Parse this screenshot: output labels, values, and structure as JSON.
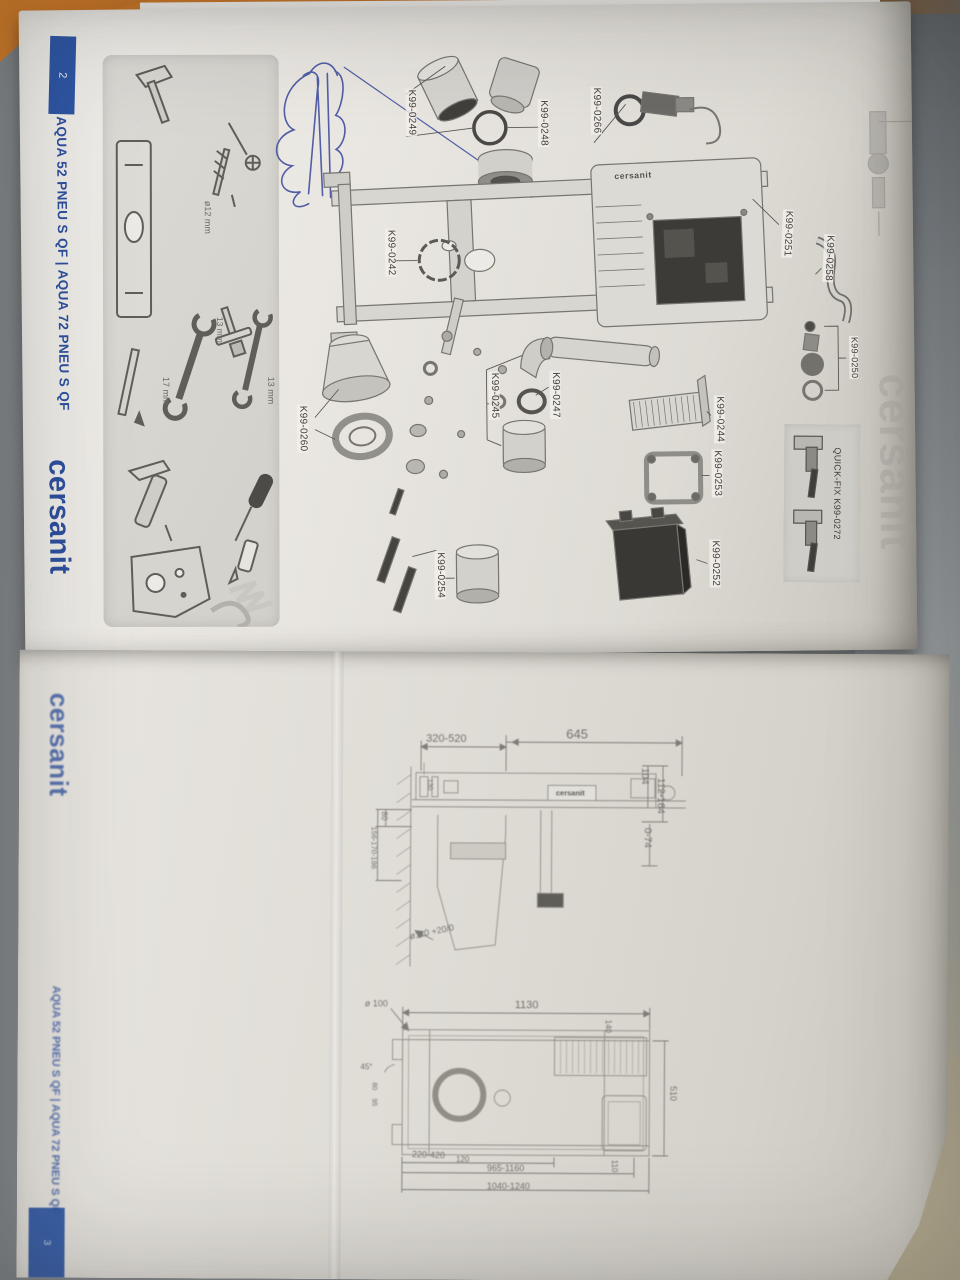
{
  "page_top": {
    "tab_number": "2",
    "title": "AQUA 52 PNEU S QF | AQUA 72 PNEU S QF",
    "logo": "cersanit",
    "tank_logo": "cersanit",
    "watermark": "cersanit",
    "tools": {
      "drill": "ø12 mm",
      "wrench_17": "17 mm",
      "wrench_13": "13 mm",
      "socket_13": "13 mm"
    },
    "quick_fix": "QUICK-FIX K99-0272",
    "parts": {
      "p0249": "K99-0249",
      "p0248": "K99-0248",
      "p0266": "K99-0266",
      "p0242": "K99-0242",
      "p0251": "K99-0251",
      "p0258": "K99-0258",
      "p0250": "K99-0250",
      "p0245": "K99-0245",
      "p0247": "K99-0247",
      "p0244": "K99-0244",
      "p0253": "K99-0253",
      "p0252": "K99-0252",
      "p0254": "K99-0254",
      "p0260": "K99-0260"
    }
  },
  "page_bottom": {
    "tab_number": "3",
    "title": "AQUA 52 PNEU S QF | AQUA 72 PNEU S QF",
    "logo": "cersanit",
    "side_view": {
      "frame_label": "cersanit",
      "dims": [
        "320-520",
        "645",
        "104",
        "112-164",
        "0-74",
        "130",
        "80",
        "156-170-186",
        "ø110 +20/0"
      ]
    },
    "front_view": {
      "dims": [
        "ø 100",
        "1130",
        "140",
        "510",
        "45°",
        "80",
        "95",
        "220-420",
        "120",
        "965-1160",
        "1040-1240",
        "110"
      ]
    }
  },
  "colors": {
    "accent_blue": "#2e56a4",
    "paper": "#e9e6e1",
    "wood": "#c86f24",
    "desk_gray": "#93979a",
    "ink": "#5c5b57"
  }
}
